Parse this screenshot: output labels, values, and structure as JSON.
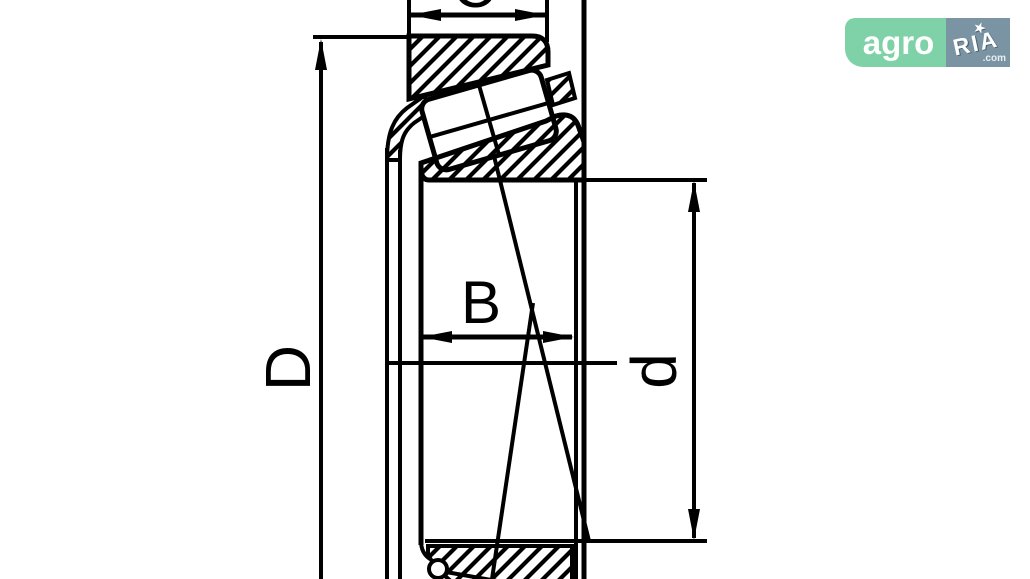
{
  "drawing": {
    "title": "tapered roller bearing cross-section",
    "labels": {
      "outer_diameter": "D",
      "inner_ring_width": "B",
      "bore_diameter": "d",
      "outer_ring_width": "C"
    },
    "line_color": "#000000",
    "background": "#ffffff"
  },
  "logo": {
    "left_text": "agro",
    "right_text": "RIA",
    "domain_suffix": ".com",
    "star": "★",
    "green": "#7fd2a8",
    "gray": "#7b94a4"
  }
}
